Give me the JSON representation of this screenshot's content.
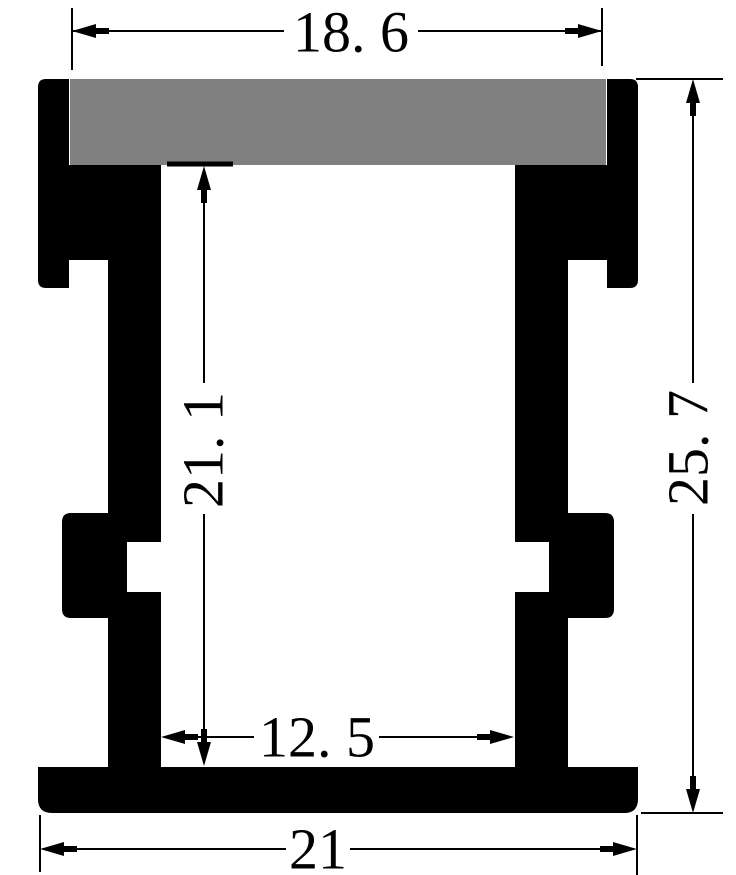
{
  "title": "aluminum-led-profile-cross-section-drawing",
  "colors": {
    "background": "#ffffff",
    "profile": "#000000",
    "diffuser": "#808080",
    "dimension": "#000000"
  },
  "dimensions": {
    "top_width": {
      "label": "18. 6"
    },
    "overall_height": {
      "label": "25. 7"
    },
    "inner_height": {
      "label": "21. 1"
    },
    "inner_width": {
      "label": "12. 5"
    },
    "overall_width": {
      "label": "21"
    }
  },
  "drawing": {
    "width": 736,
    "height": 875,
    "profile_shapes": [
      {
        "name": "diffuser-slab",
        "fill": "diffuser",
        "d": "M70,79 H606 V165 H575 V222 Q575,227 570,227 H547 Q542,227 542,222 V165 H134 V222 Q134,227 129,227 H106 Q101,227 101,222 V165 H70 Z"
      },
      {
        "name": "outer-wall-left",
        "fill": "profile",
        "d": "M69,79 H46 Q38,79 38,87 V280 Q38,288 46,288 H69 Z"
      },
      {
        "name": "outer-wall-right",
        "fill": "profile",
        "d": "M607,79 H630 Q638,79 638,87 V280 Q638,288 630,288 H607 Z"
      },
      {
        "name": "top-block-left",
        "fill": "profile",
        "d": "M69,165 H161 V260 H69 Z"
      },
      {
        "name": "top-block-right",
        "fill": "profile",
        "d": "M515,165 H607 V260 H515 Z"
      },
      {
        "name": "inner-column-left",
        "fill": "profile",
        "d": "M108,260 H161 V542 H127 V592 H161 V767 H108 Z"
      },
      {
        "name": "inner-column-right",
        "fill": "profile",
        "d": "M568,260 H515 V542 H549 V592 H515 V767 H568 Z"
      },
      {
        "name": "clip-bump-left",
        "fill": "profile",
        "d": "M108,513 H71 Q62,513 62,522 V609 Q62,618 71,618 H108 Z"
      },
      {
        "name": "clip-bump-right",
        "fill": "profile",
        "d": "M568,513 H605 Q614,513 614,522 V609 Q614,618 605,618 H568 Z"
      },
      {
        "name": "base-plate",
        "fill": "profile",
        "d": "M38,767 H638 V799 Q638,813 624,813 H52 Q38,813 38,799 Z"
      }
    ],
    "lines": [
      {
        "name": "ext-line-top-width-left",
        "x1": 72,
        "y1": 8,
        "x2": 72,
        "y2": 70,
        "w": 2
      },
      {
        "name": "ext-line-top-width-right",
        "x1": 602,
        "y1": 8,
        "x2": 602,
        "y2": 66,
        "w": 2
      },
      {
        "name": "dim-line-top-width-a",
        "x1": 72,
        "y1": 31,
        "x2": 284,
        "y2": 31,
        "w": 2
      },
      {
        "name": "dim-line-top-width-b",
        "x1": 418,
        "y1": 31,
        "x2": 602,
        "y2": 31,
        "w": 2
      },
      {
        "name": "ext-line-overall-height-top",
        "x1": 636,
        "y1": 79,
        "x2": 723,
        "y2": 79,
        "w": 2
      },
      {
        "name": "ext-line-overall-height-bottom",
        "x1": 641,
        "y1": 813,
        "x2": 723,
        "y2": 813,
        "w": 2
      },
      {
        "name": "dim-line-overall-height-a",
        "x1": 693,
        "y1": 83,
        "x2": 693,
        "y2": 383,
        "w": 2
      },
      {
        "name": "dim-line-overall-height-b",
        "x1": 693,
        "y1": 514,
        "x2": 693,
        "y2": 809,
        "w": 2
      },
      {
        "name": "ref-tick-inner-height",
        "x1": 167,
        "y1": 164,
        "x2": 233,
        "y2": 164,
        "w": 5
      },
      {
        "name": "dim-line-inner-height-a",
        "x1": 204,
        "y1": 170,
        "x2": 204,
        "y2": 383,
        "w": 2
      },
      {
        "name": "dim-line-inner-height-b",
        "x1": 204,
        "y1": 514,
        "x2": 204,
        "y2": 762,
        "w": 2
      },
      {
        "name": "dim-line-inner-width-a",
        "x1": 189,
        "y1": 737,
        "x2": 254,
        "y2": 737,
        "w": 2
      },
      {
        "name": "dim-line-inner-width-b",
        "x1": 379,
        "y1": 737,
        "x2": 488,
        "y2": 737,
        "w": 2
      },
      {
        "name": "ext-line-overall-width-left",
        "x1": 40,
        "y1": 815,
        "x2": 40,
        "y2": 872,
        "w": 2
      },
      {
        "name": "ext-line-overall-width-right",
        "x1": 637,
        "y1": 815,
        "x2": 637,
        "y2": 875,
        "w": 2
      },
      {
        "name": "dim-line-overall-width-a",
        "x1": 43,
        "y1": 849,
        "x2": 286,
        "y2": 849,
        "w": 2
      },
      {
        "name": "dim-line-overall-width-b",
        "x1": 350,
        "y1": 849,
        "x2": 634,
        "y2": 849,
        "w": 2
      }
    ],
    "arrows": [
      {
        "name": "arrow-top-width-left",
        "x": 72,
        "y": 31,
        "dir": "left"
      },
      {
        "name": "arrow-top-width-right",
        "x": 602,
        "y": 31,
        "dir": "right"
      },
      {
        "name": "arrow-overall-height-top",
        "x": 693,
        "y": 79,
        "dir": "up"
      },
      {
        "name": "arrow-overall-height-bottom",
        "x": 693,
        "y": 813,
        "dir": "down"
      },
      {
        "name": "arrow-inner-height-top",
        "x": 204,
        "y": 166,
        "dir": "up"
      },
      {
        "name": "arrow-inner-height-bottom",
        "x": 204,
        "y": 766,
        "dir": "down"
      },
      {
        "name": "arrow-inner-width-left",
        "x": 161,
        "y": 737,
        "dir": "left"
      },
      {
        "name": "arrow-inner-width-right",
        "x": 514,
        "y": 737,
        "dir": "right"
      },
      {
        "name": "arrow-overall-width-left",
        "x": 40,
        "y": 849,
        "dir": "left"
      },
      {
        "name": "arrow-overall-width-right",
        "x": 637,
        "y": 849,
        "dir": "right"
      }
    ],
    "labels": [
      {
        "name": "dim-label-top-width",
        "bind": "dimensions.top_width.label",
        "x": 351,
        "y": 32,
        "rotate": 0
      },
      {
        "name": "dim-label-overall-height",
        "bind": "dimensions.overall_height.label",
        "x": 688,
        "y": 448,
        "rotate": -90
      },
      {
        "name": "dim-label-inner-height",
        "bind": "dimensions.inner_height.label",
        "x": 203,
        "y": 450,
        "rotate": -90
      },
      {
        "name": "dim-label-inner-width",
        "bind": "dimensions.inner_width.label",
        "x": 317,
        "y": 737,
        "rotate": 0
      },
      {
        "name": "dim-label-overall-width",
        "bind": "dimensions.overall_width.label",
        "x": 318,
        "y": 849,
        "rotate": 0
      }
    ]
  }
}
